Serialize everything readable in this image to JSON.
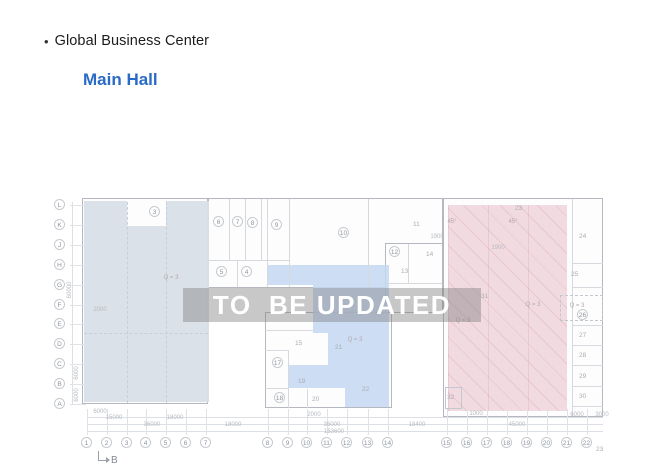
{
  "slide": {
    "bullet": "•",
    "title": "Global Business Center",
    "subtitle": "Main Hall"
  },
  "colors": {
    "subtitle_blue": "#2a6bc6",
    "shade_left": "#d9dfe7",
    "shade_center": "#c3d7f2",
    "shade_right": "#f1d7de",
    "watermark_bg": "rgba(125,125,125,0.42)",
    "watermark_text": "#ffffff"
  },
  "floorplan": {
    "watermark": "TO  BE UPDATED",
    "marker_b": "B",
    "grid_rows": [
      {
        "label": "L",
        "x": 60,
        "y": 110
      },
      {
        "label": "K",
        "x": 60,
        "y": 130
      },
      {
        "label": "J",
        "x": 60,
        "y": 150
      },
      {
        "label": "H",
        "x": 60,
        "y": 170
      },
      {
        "label": "G",
        "x": 60,
        "y": 190
      },
      {
        "label": "F",
        "x": 60,
        "y": 210
      },
      {
        "label": "E",
        "x": 60,
        "y": 229
      },
      {
        "label": "D",
        "x": 60,
        "y": 249
      },
      {
        "label": "C",
        "x": 60,
        "y": 269
      },
      {
        "label": "B",
        "x": 60,
        "y": 289
      },
      {
        "label": "A",
        "x": 60,
        "y": 309
      }
    ],
    "grid_cols": [
      {
        "label": "1",
        "x": 87,
        "y": 348
      },
      {
        "label": "2",
        "x": 107,
        "y": 348
      },
      {
        "label": "3",
        "x": 127,
        "y": 348
      },
      {
        "label": "4",
        "x": 146,
        "y": 348
      },
      {
        "label": "5",
        "x": 166,
        "y": 348
      },
      {
        "label": "6",
        "x": 186,
        "y": 348
      },
      {
        "label": "7",
        "x": 206,
        "y": 348
      },
      {
        "label": "8",
        "x": 268,
        "y": 348
      },
      {
        "label": "9",
        "x": 288,
        "y": 348
      },
      {
        "label": "10",
        "x": 307,
        "y": 348
      },
      {
        "label": "11",
        "x": 327,
        "y": 348
      },
      {
        "label": "12",
        "x": 347,
        "y": 348
      },
      {
        "label": "13",
        "x": 368,
        "y": 348
      },
      {
        "label": "14",
        "x": 388,
        "y": 348
      },
      {
        "label": "15",
        "x": 447,
        "y": 348
      },
      {
        "label": "16",
        "x": 467,
        "y": 348
      },
      {
        "label": "17",
        "x": 487,
        "y": 348
      },
      {
        "label": "18",
        "x": 507,
        "y": 348
      },
      {
        "label": "19",
        "x": 527,
        "y": 348
      },
      {
        "label": "20",
        "x": 547,
        "y": 348
      },
      {
        "label": "21",
        "x": 567,
        "y": 348
      },
      {
        "label": "22",
        "x": 587,
        "y": 348
      },
      {
        "label": "23",
        "x": 601,
        "y": 354,
        "cls": "plain"
      }
    ],
    "rooms": [
      {
        "label": "3",
        "x": 155,
        "y": 117
      },
      {
        "label": "6",
        "x": 219,
        "y": 127
      },
      {
        "label": "7",
        "x": 238,
        "y": 127
      },
      {
        "label": "8",
        "x": 253,
        "y": 128
      },
      {
        "label": "9",
        "x": 277,
        "y": 130
      },
      {
        "label": "10",
        "x": 344,
        "y": 138
      },
      {
        "label": "5",
        "x": 222,
        "y": 177
      },
      {
        "label": "4",
        "x": 247,
        "y": 177
      },
      {
        "label": "12",
        "x": 395,
        "y": 157
      },
      {
        "label": "17",
        "x": 278,
        "y": 268
      },
      {
        "label": "18",
        "x": 280,
        "y": 303
      },
      {
        "label": "26",
        "x": 583,
        "y": 220
      },
      {
        "label": "11",
        "x": 418,
        "y": 129,
        "cls": "plain"
      },
      {
        "label": "13",
        "x": 406,
        "y": 176,
        "cls": "plain"
      },
      {
        "label": "14",
        "x": 431,
        "y": 159,
        "cls": "plain"
      },
      {
        "label": "15",
        "x": 300,
        "y": 248,
        "cls": "plain"
      },
      {
        "label": "19",
        "x": 303,
        "y": 286,
        "cls": "plain"
      },
      {
        "label": "20",
        "x": 317,
        "y": 304,
        "cls": "plain"
      },
      {
        "label": "21",
        "x": 340,
        "y": 252,
        "cls": "plain"
      },
      {
        "label": "22",
        "x": 367,
        "y": 294,
        "cls": "plain"
      },
      {
        "label": "23",
        "x": 520,
        "y": 113,
        "cls": "plain"
      },
      {
        "label": "24",
        "x": 584,
        "y": 141,
        "cls": "plain"
      },
      {
        "label": "25",
        "x": 576,
        "y": 179,
        "cls": "plain"
      },
      {
        "label": "27",
        "x": 584,
        "y": 240,
        "cls": "plain"
      },
      {
        "label": "28",
        "x": 584,
        "y": 260,
        "cls": "plain"
      },
      {
        "label": "29",
        "x": 584,
        "y": 281,
        "cls": "plain"
      },
      {
        "label": "30",
        "x": 584,
        "y": 301,
        "cls": "plain"
      },
      {
        "label": "31",
        "x": 486,
        "y": 201,
        "cls": "plain"
      },
      {
        "label": "32",
        "x": 452,
        "y": 302,
        "cls": "plain"
      }
    ],
    "notes": [
      {
        "label": "Q = 3",
        "x": 171,
        "y": 183
      },
      {
        "label": "Q = 3",
        "x": 355,
        "y": 245
      },
      {
        "label": "Q = 3",
        "x": 533,
        "y": 210
      },
      {
        "label": "Q = 3",
        "x": 463,
        "y": 226
      },
      {
        "label": "Q = 3",
        "x": 577,
        "y": 211
      },
      {
        "label": "45°",
        "x": 452,
        "y": 127
      },
      {
        "label": "45°",
        "x": 513,
        "y": 127
      }
    ],
    "dims": [
      {
        "label": "6000",
        "x": 100,
        "y": 317
      },
      {
        "label": "15000",
        "x": 114,
        "y": 323
      },
      {
        "label": "18000",
        "x": 175,
        "y": 323
      },
      {
        "label": "36000",
        "x": 152,
        "y": 330
      },
      {
        "label": "18000",
        "x": 233,
        "y": 330
      },
      {
        "label": "2000",
        "x": 100,
        "y": 215
      },
      {
        "label": "2000",
        "x": 314,
        "y": 320
      },
      {
        "label": "36000",
        "x": 332,
        "y": 330
      },
      {
        "label": "153600",
        "x": 334,
        "y": 337
      },
      {
        "label": "18400",
        "x": 417,
        "y": 330
      },
      {
        "label": "1000",
        "x": 476,
        "y": 319
      },
      {
        "label": "45000",
        "x": 517,
        "y": 330
      },
      {
        "label": "6000",
        "x": 577,
        "y": 320
      },
      {
        "label": "3000",
        "x": 602,
        "y": 320
      },
      {
        "label": "1900",
        "x": 437,
        "y": 142
      },
      {
        "label": "1900",
        "x": 498,
        "y": 153
      },
      {
        "label": "60000",
        "x": 70,
        "y": 195,
        "cls": "rot"
      },
      {
        "label": "6000",
        "x": 77,
        "y": 278,
        "cls": "rot"
      },
      {
        "label": "6000",
        "x": 77,
        "y": 300,
        "cls": "rot"
      }
    ]
  }
}
